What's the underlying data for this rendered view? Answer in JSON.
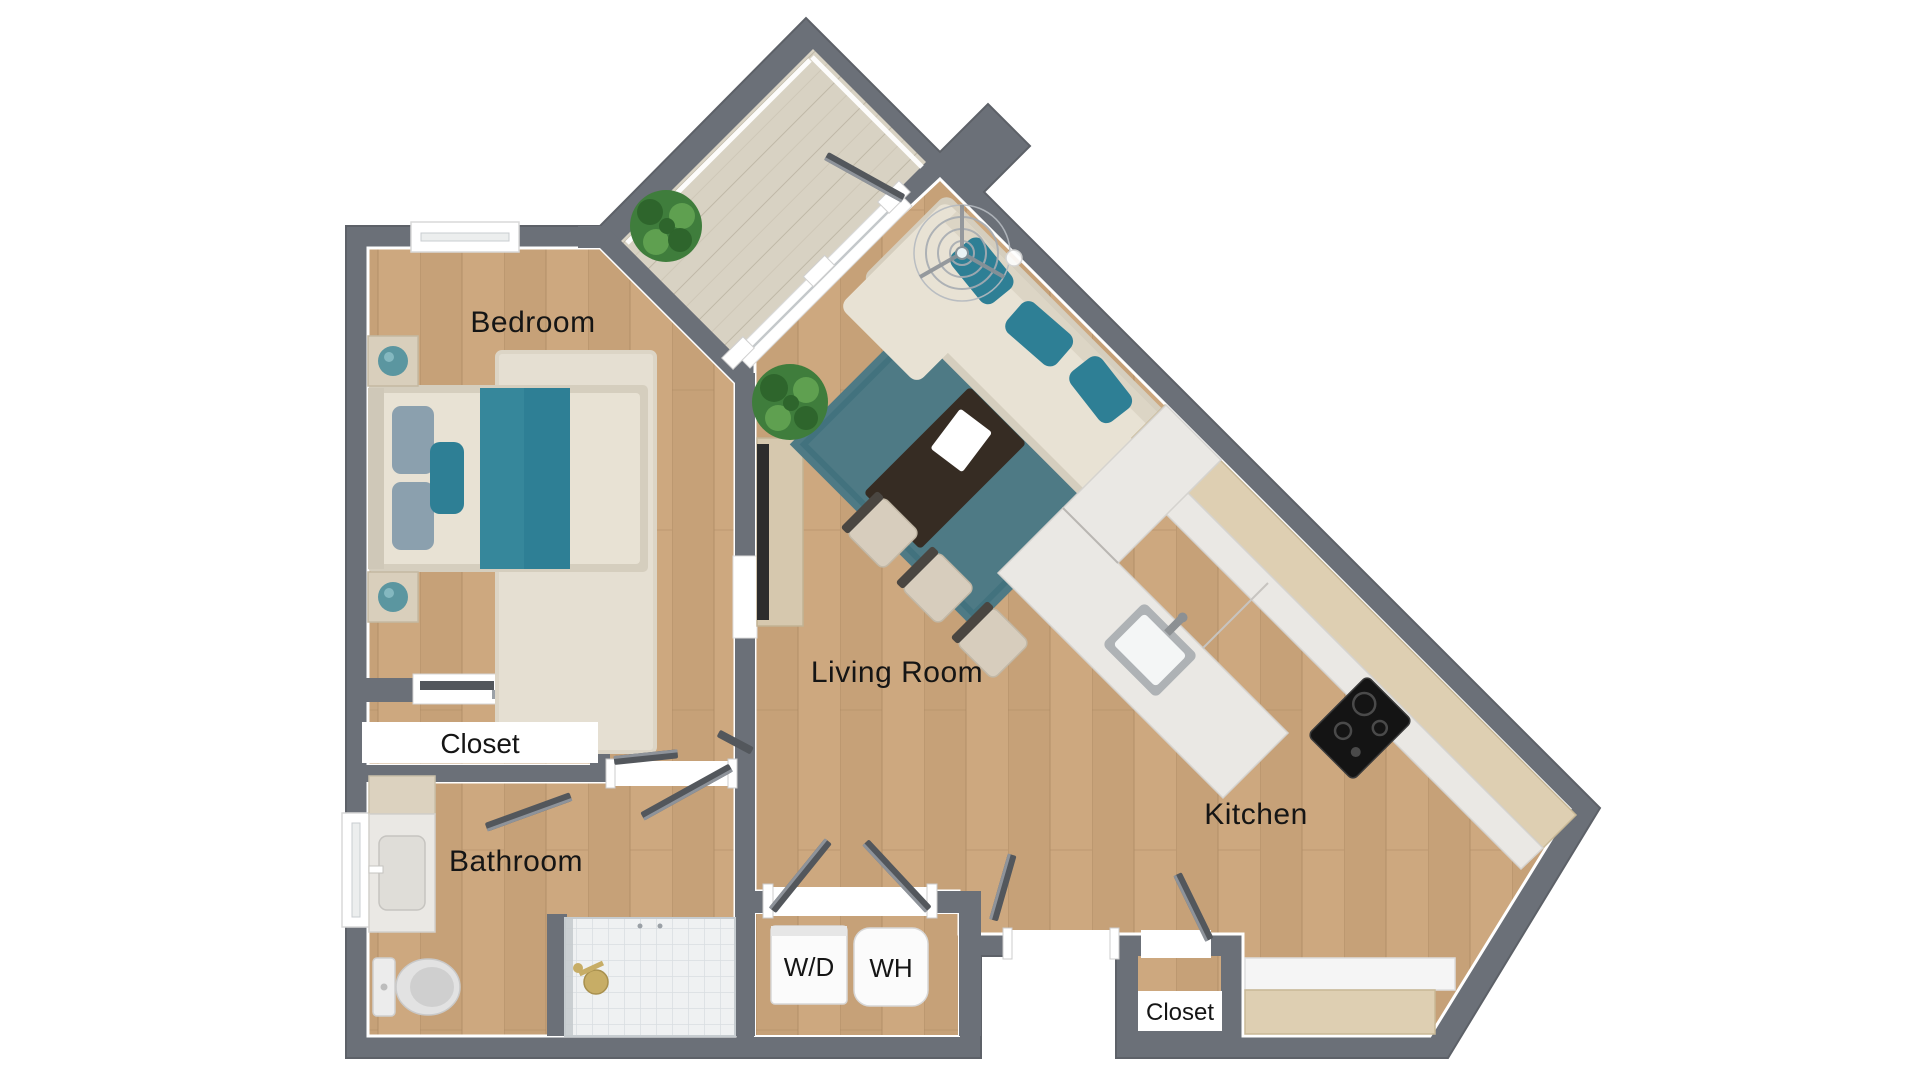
{
  "floorplan": {
    "type": "apartment-floor-plan-3d-top-view",
    "labels": {
      "bedroom": "Bedroom",
      "closet_bedroom": "Closet",
      "bathroom": "Bathroom",
      "living_room": "Living Room",
      "kitchen": "Kitchen",
      "washer_dryer": "W/D",
      "water_heater": "WH",
      "closet_entry": "Closet"
    },
    "colors": {
      "wall": "#6b7078",
      "wall_dark": "#5d6168",
      "floor_wood": "#cda87f",
      "floor_wood_dark": "#c09a72",
      "floor_line": "#ab8a63",
      "deck": "#d8d2c3",
      "deck_line": "#b9b1a0",
      "white": "#ffffff",
      "door_leaf": "#53575c",
      "door_edge": "#8e939a",
      "teal_dark": "#2e7f95",
      "teal_rug": "#4e7a85",
      "teal_rug_line": "#40707c",
      "teal_lamp": "#5b96a0",
      "cream": "#e8e2d4",
      "cream_dark": "#d5cebe",
      "rug_cream": "#e5dfd2",
      "table_dark": "#362c23",
      "marble": "#eae8e4",
      "counter_wood": "#decfb2",
      "console_wood": "#d6c8ae",
      "cooktop": "#141414",
      "tile": "#eff1f2",
      "tile_line": "#d9dee1",
      "fixture_gold": "#c7ad66",
      "appliance": "#fbfbfb",
      "plant": "#3f7d3c",
      "plant_dark": "#2e652c",
      "plant_light": "#5fa050",
      "stool": "#d7cdbd",
      "stool_back": "#4a4641",
      "gray_fixture": "#c9ccce",
      "text": "#151515"
    }
  }
}
